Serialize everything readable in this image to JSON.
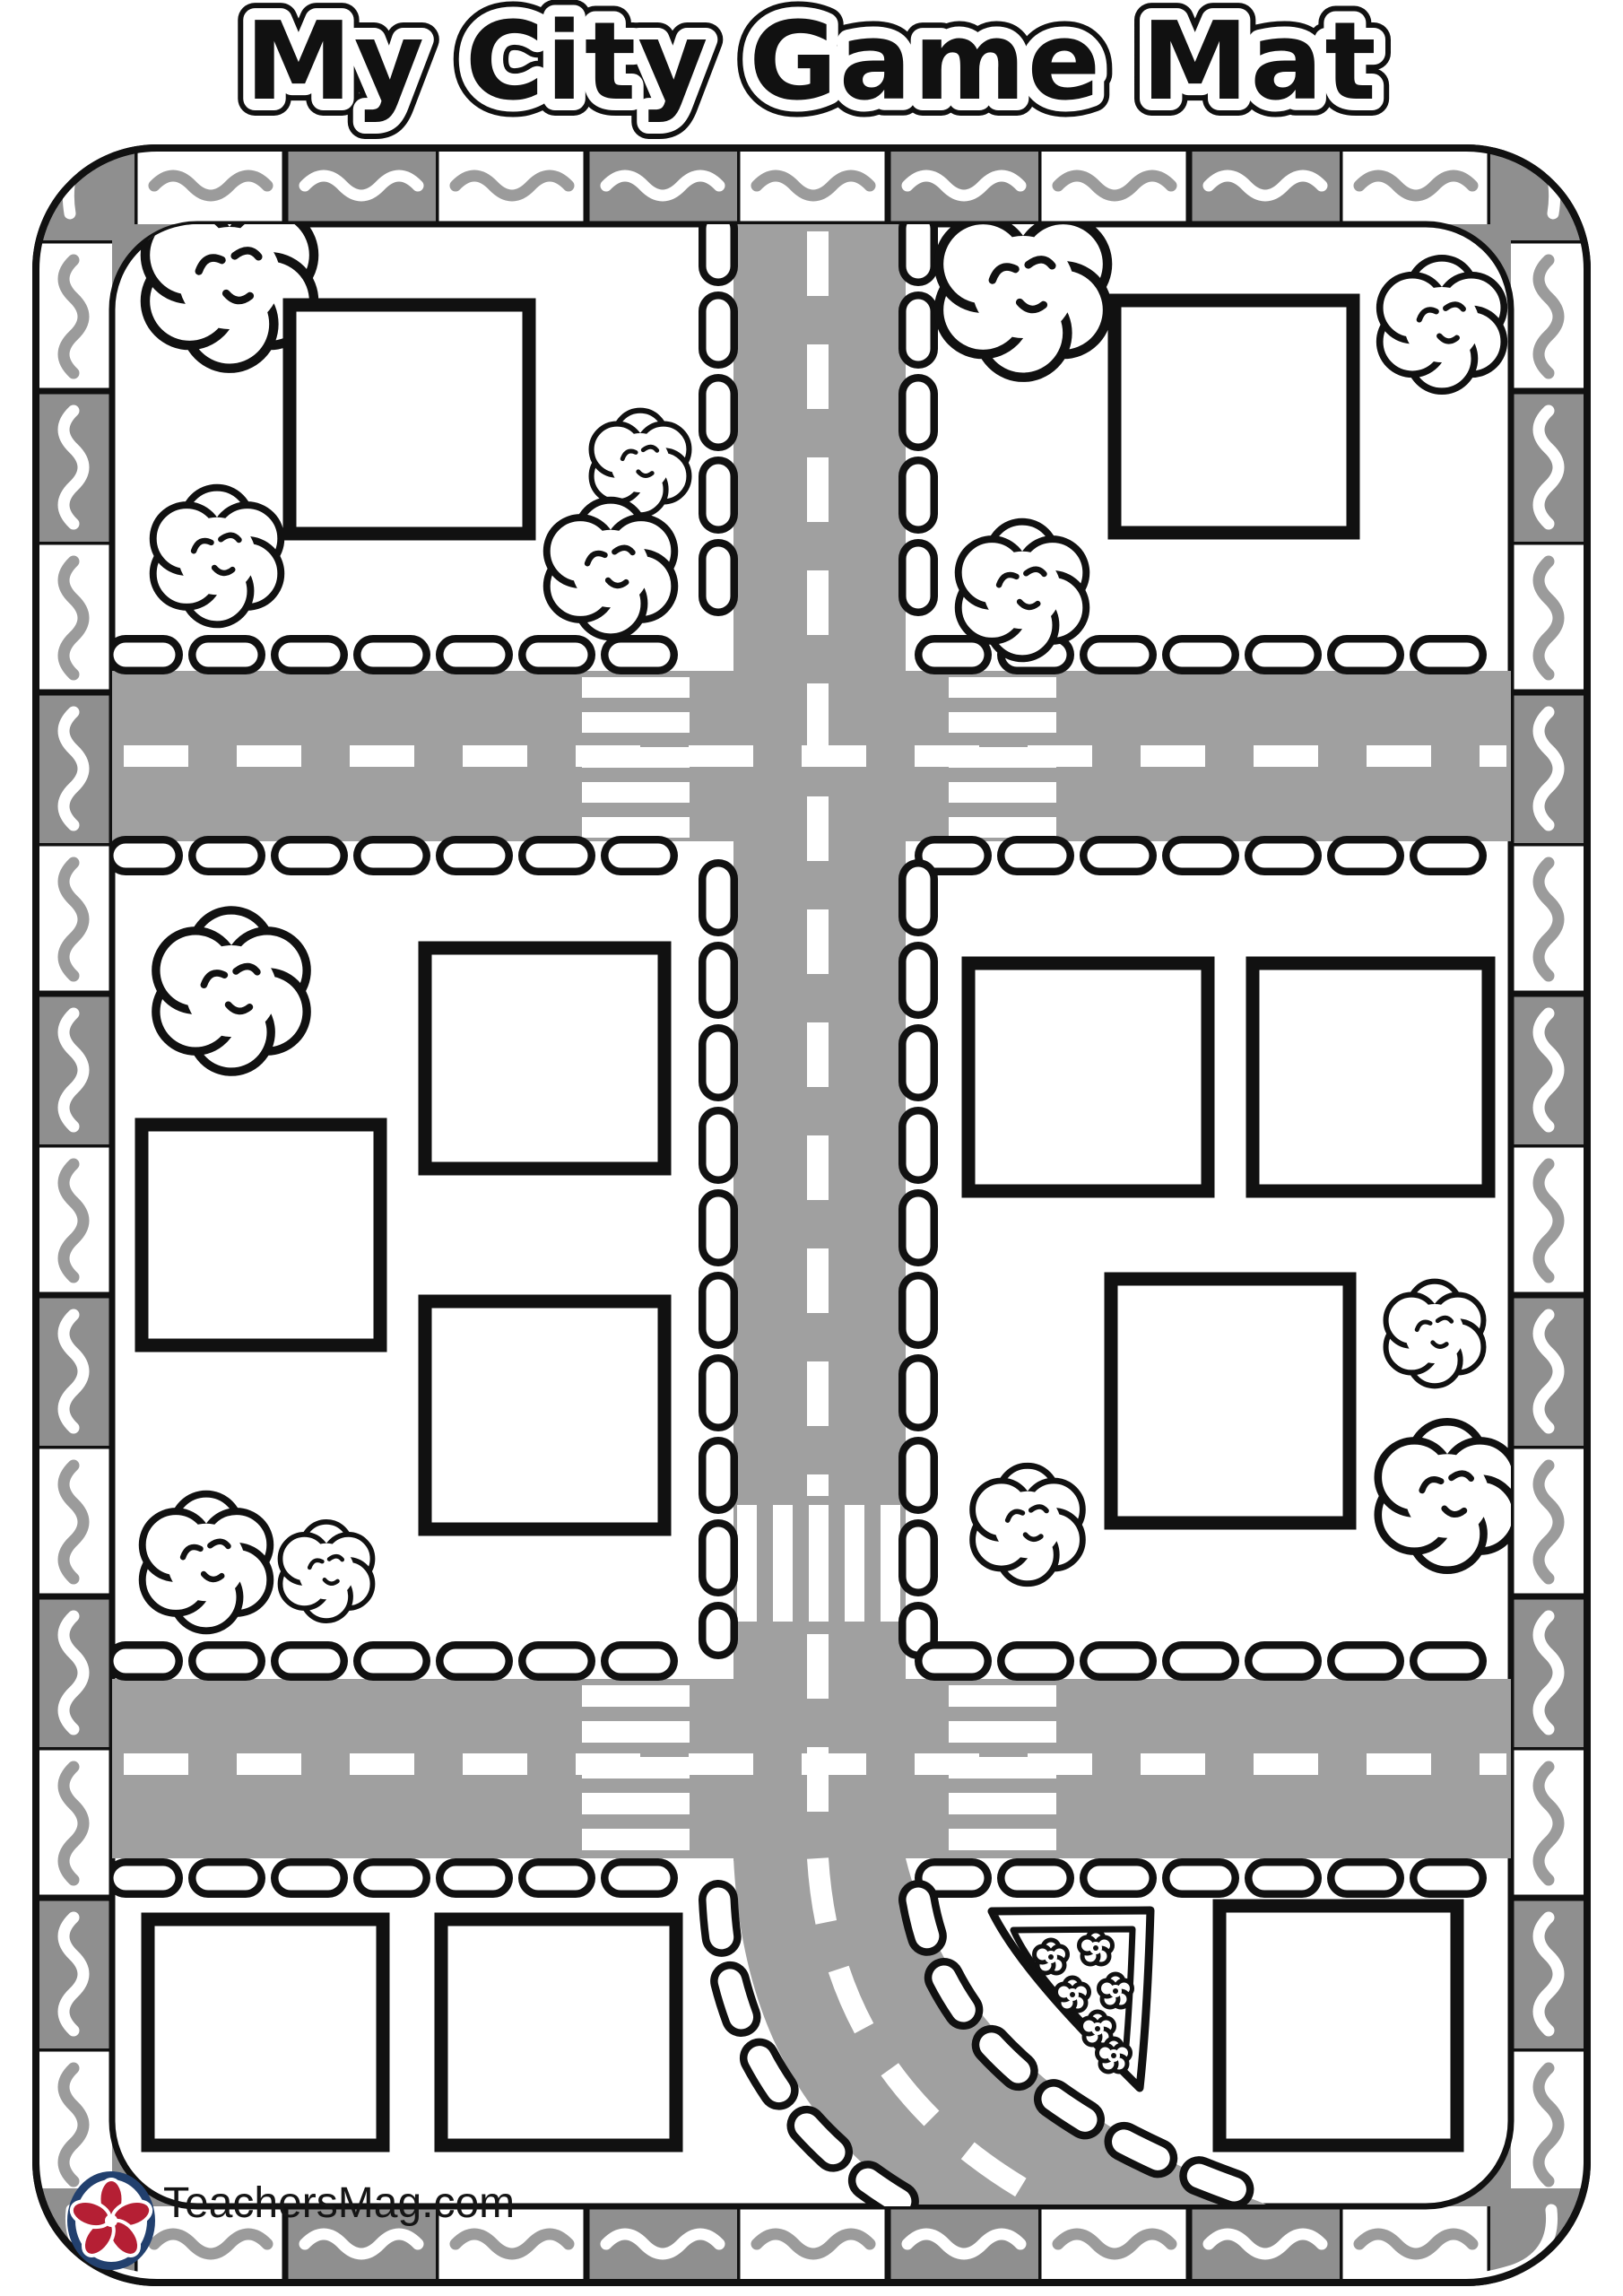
{
  "title": "My City Game Mat",
  "footer": {
    "logo_text": "TeachersMag.com",
    "logo_icon": "flower-icon"
  },
  "colors": {
    "road": "#a0a0a0",
    "tile": "#8f8f8f",
    "squig": "#9b9b9b",
    "ink": "#111111",
    "navy": "#22406e",
    "red": "#b51f34"
  },
  "scene": {
    "building_slots": 11,
    "bushes": 13,
    "horizontal_roads": 2,
    "vertical_roads": 1,
    "crosswalks": 5,
    "border_style": "alternating gray and white tiles with wavy squiggles",
    "decorations": [
      "smiling-bush",
      "pizza-slice-with-flowers"
    ]
  }
}
